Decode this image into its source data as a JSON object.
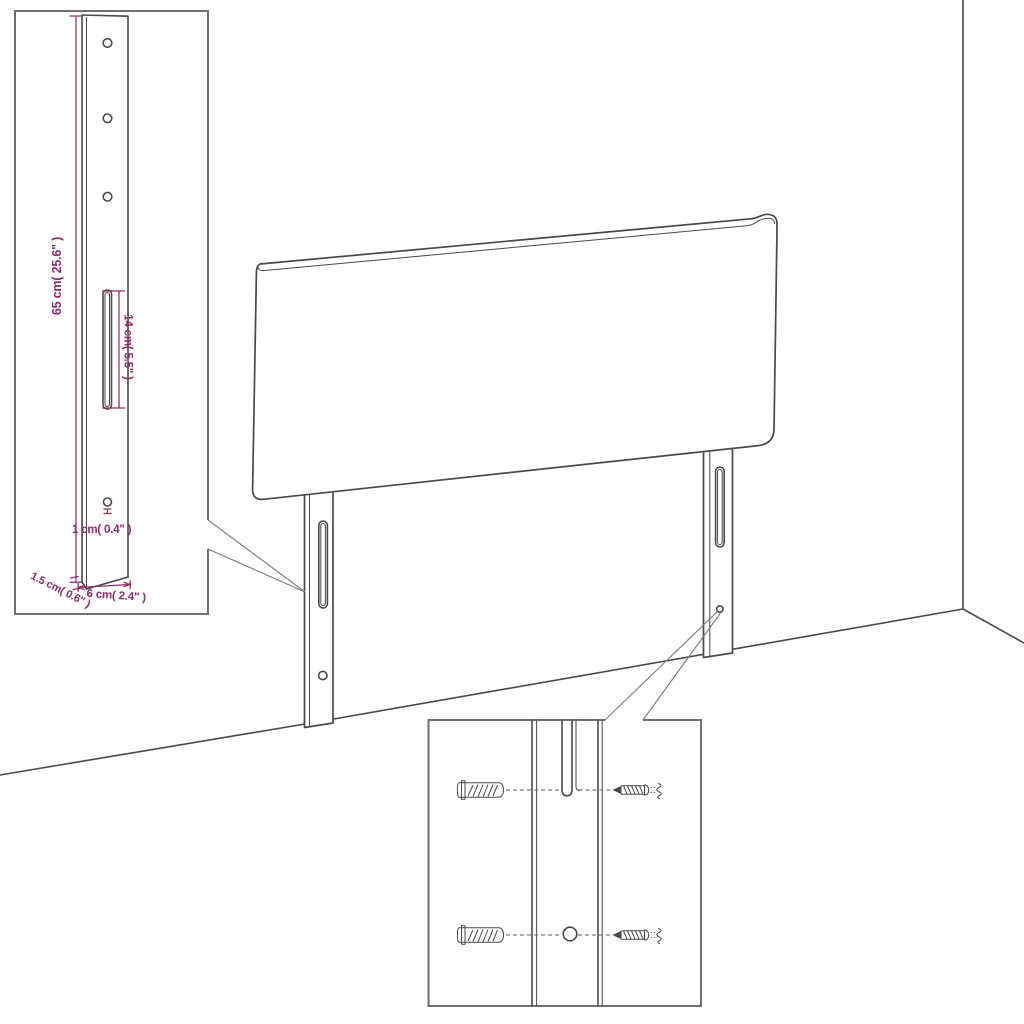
{
  "diagram": {
    "labels": {
      "bracket_height": "65 cm( 25.6\" )",
      "slot_length": "14 cm( 5.5\" )",
      "hole_diameter": "1 cm( 0.4\" )",
      "bracket_thickness": "1.5 cm( 0.6\" )",
      "bracket_width": "6 cm( 2.4\" )"
    },
    "colors": {
      "dimension": "#8e2c6c",
      "line_art": "#4a4a4a",
      "inset_border": "#707070",
      "leader": "#828282",
      "dashed": "#5f5f5f",
      "background": "#ffffff"
    }
  }
}
